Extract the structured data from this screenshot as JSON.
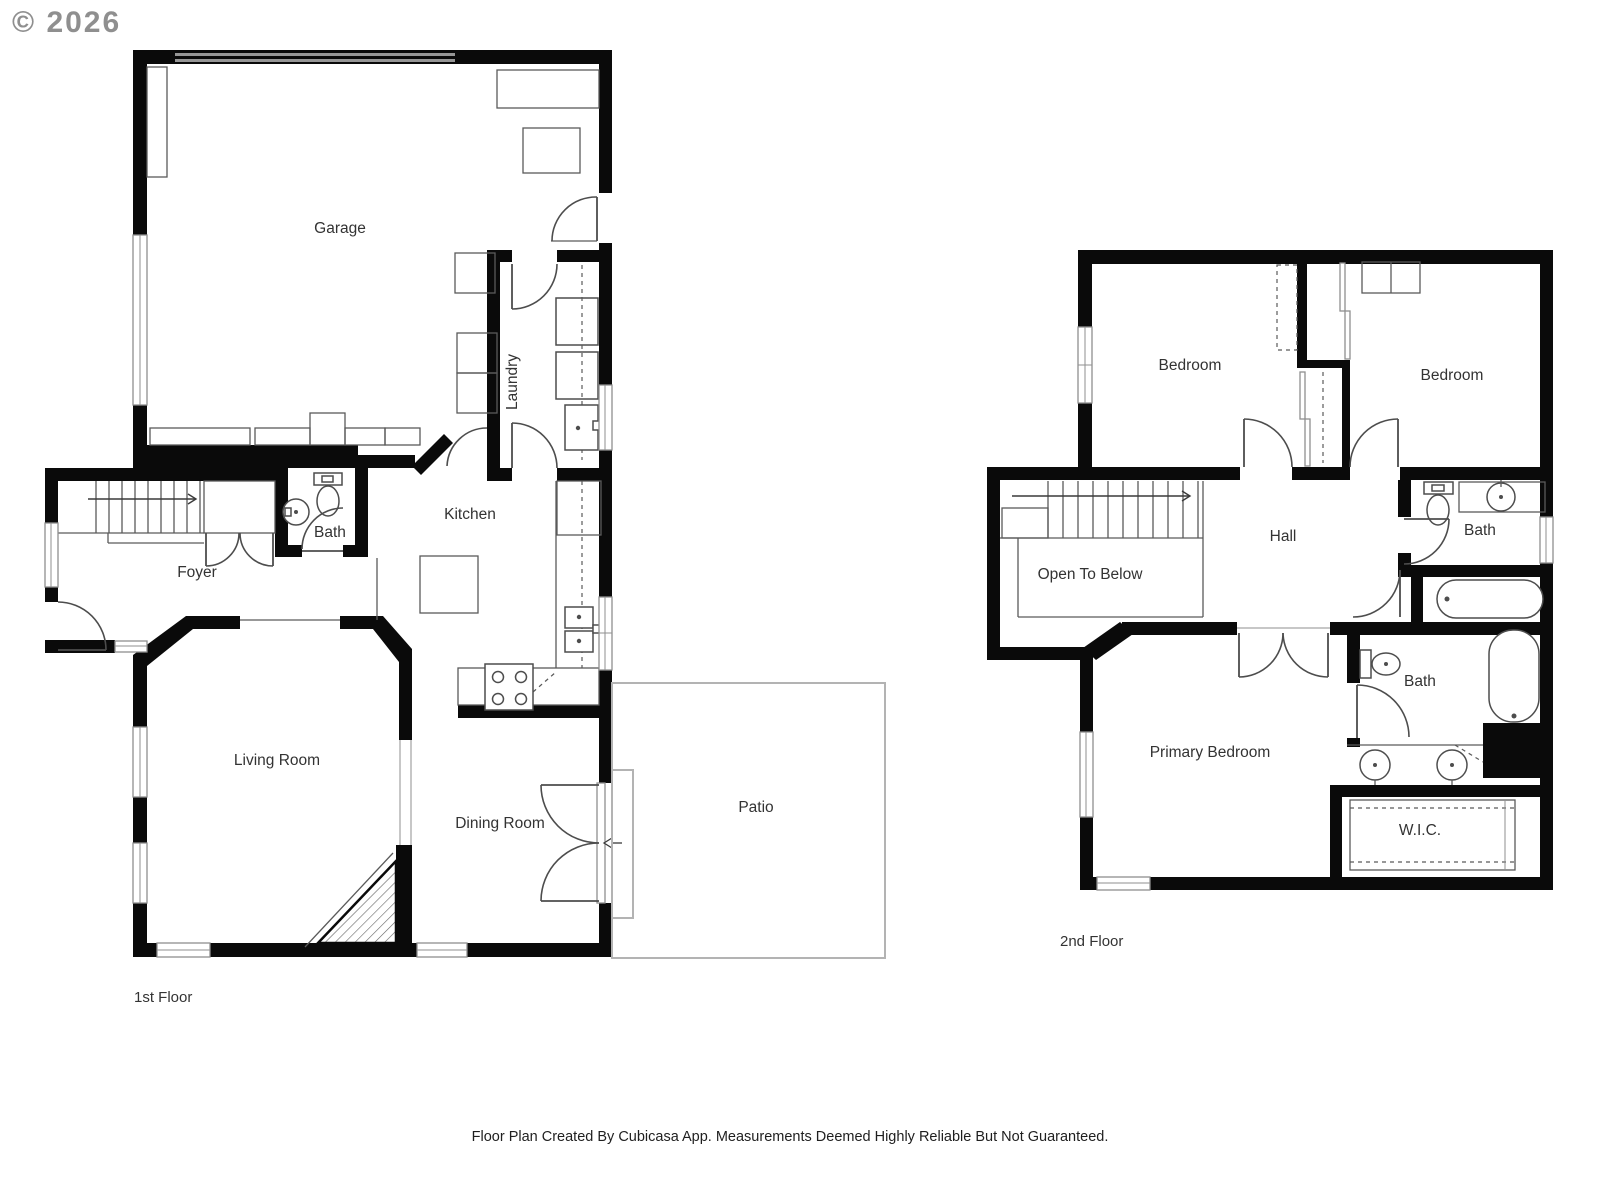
{
  "copyright": "© 2026",
  "footer": "Floor Plan Created By Cubicasa App. Measurements Deemed Highly Reliable But Not Guaranteed.",
  "colors": {
    "wall": "#0a0a0a",
    "fixture": "#4d4d4d",
    "text": "#333333"
  },
  "floor1": {
    "label": "1st Floor",
    "rooms": {
      "garage": "Garage",
      "laundry": "Laundry",
      "kitchen": "Kitchen",
      "bath": "Bath",
      "foyer": "Foyer",
      "living": "Living Room",
      "dining": "Dining Room",
      "patio": "Patio"
    }
  },
  "floor2": {
    "label": "2nd Floor",
    "rooms": {
      "bedroom_left": "Bedroom",
      "bedroom_right": "Bedroom",
      "hall": "Hall",
      "open_to_below": "Open To Below",
      "bath_hall": "Bath",
      "bath_primary": "Bath",
      "primary": "Primary Bedroom",
      "wic": "W.I.C."
    }
  }
}
